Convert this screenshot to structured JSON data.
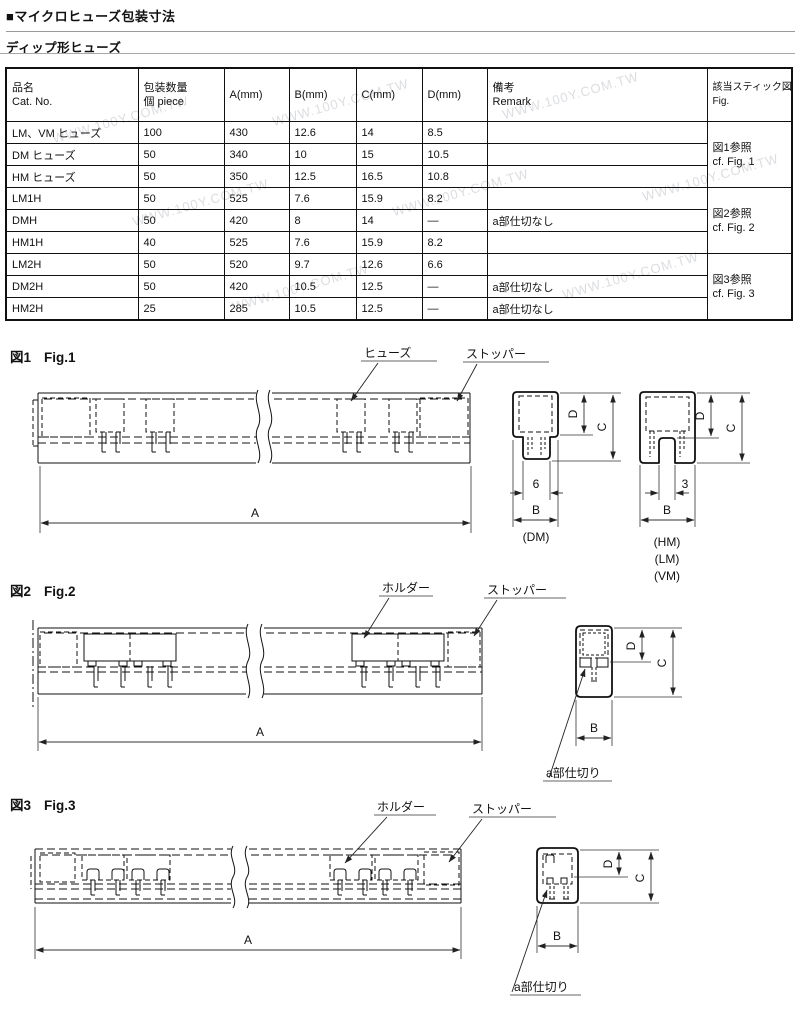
{
  "page": {
    "title": "■マイクロヒューズ包装寸法",
    "subtitle": "ディップ形ヒューズ",
    "watermark": "WWW.100Y.COM.TW"
  },
  "table": {
    "headers": {
      "name_jp": "品名",
      "name_en": "Cat. No.",
      "qty_jp": "包装数量",
      "qty_en": "個  piece",
      "a": "A(mm)",
      "b": "B(mm)",
      "c": "C(mm)",
      "d": "D(mm)",
      "remark_jp": "備考",
      "remark_en": "Remark",
      "fig_jp": "該当スティック図面",
      "fig_en": "Fig."
    },
    "rows": [
      {
        "name": "LM、VM ヒューズ",
        "qty": "100",
        "a": "430",
        "b": "12.6",
        "c": "14",
        "d": "8.5",
        "remark": ""
      },
      {
        "name": "DM ヒューズ",
        "qty": "50",
        "a": "340",
        "b": "10",
        "c": "15",
        "d": "10.5",
        "remark": ""
      },
      {
        "name": "HM ヒューズ",
        "qty": "50",
        "a": "350",
        "b": "12.5",
        "c": "16.5",
        "d": "10.8",
        "remark": ""
      },
      {
        "name": "LM1H",
        "qty": "50",
        "a": "525",
        "b": "7.6",
        "c": "15.9",
        "d": "8.2",
        "remark": ""
      },
      {
        "name": "DMH",
        "qty": "50",
        "a": "420",
        "b": "8",
        "c": "14",
        "d": "—",
        "remark": "a部仕切なし"
      },
      {
        "name": "HM1H",
        "qty": "40",
        "a": "525",
        "b": "7.6",
        "c": "15.9",
        "d": "8.2",
        "remark": ""
      },
      {
        "name": "LM2H",
        "qty": "50",
        "a": "520",
        "b": "9.7",
        "c": "12.6",
        "d": "6.6",
        "remark": ""
      },
      {
        "name": "DM2H",
        "qty": "50",
        "a": "420",
        "b": "10.5",
        "c": "12.5",
        "d": "—",
        "remark": "a部仕切なし"
      },
      {
        "name": "HM2H",
        "qty": "25",
        "a": "285",
        "b": "10.5",
        "c": "12.5",
        "d": "—",
        "remark": "a部仕切なし"
      }
    ],
    "figrefs": [
      {
        "jp": "図1参照",
        "en": "cf. Fig. 1"
      },
      {
        "jp": "図2参照",
        "en": "cf. Fig. 2"
      },
      {
        "jp": "図3参照",
        "en": "cf. Fig. 3"
      }
    ]
  },
  "figures": {
    "dims": {
      "a": "A",
      "b": "B",
      "c": "C",
      "d": "D"
    },
    "fig1": {
      "no": "図1",
      "name": "Fig.1",
      "fuse": "ヒューズ",
      "stopper": "ストッパー",
      "dim6": "6",
      "dim3": "3",
      "sec_dm": "(DM)",
      "sec_hm": "(HM)",
      "sec_lm": "(LM)",
      "sec_vm": "(VM)"
    },
    "fig2": {
      "no": "図2",
      "name": "Fig.2",
      "holder": "ホルダー",
      "stopper": "ストッパー",
      "partition": "a部仕切り"
    },
    "fig3": {
      "no": "図3",
      "name": "Fig.3",
      "holder": "ホルダー",
      "stopper": "ストッパー",
      "partition": "a部仕切り"
    }
  }
}
